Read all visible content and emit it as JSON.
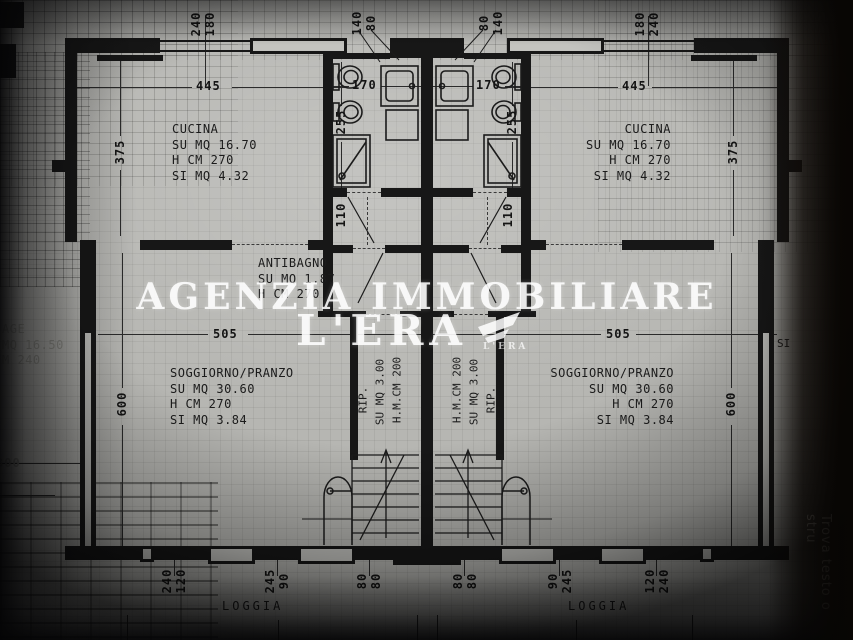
{
  "watermark": {
    "line1": "AGENZIA IMMOBILIARE",
    "line2": "L'ERA",
    "logo_caption": "L'ERA",
    "color": "#ffffff"
  },
  "side_overlay": {
    "vertical_text": "Trova testo o stru",
    "fragment_si": "SI"
  },
  "rooms": {
    "cucina_left": {
      "name": "CUCINA",
      "l2": "SU MQ 16.70",
      "l3": "H CM 270",
      "l4": "SI MQ 4.32"
    },
    "cucina_right": {
      "name": "CUCINA",
      "l2": "SU MQ 16.70",
      "l3": "H CM 270",
      "l4": "SI MQ 4.32"
    },
    "antibagno": {
      "name": "ANTIBAGNO",
      "l2": "SU MQ 1.87",
      "l3": "H CM 270"
    },
    "soggiorno_left": {
      "name": "SOGGIORNO/PRANZO",
      "l2": "SU MQ 30.60",
      "l3": "H CM 270",
      "l4": "SI MQ 3.84"
    },
    "soggiorno_right": {
      "name": "SOGGIORNO/PRANZO",
      "l2": "SU MQ 30.60",
      "l3": "H CM 270",
      "l4": "SI MQ 3.84"
    },
    "rip_left": {
      "l1": "RIP.",
      "l2": "SU MQ 3.00",
      "l3": "H.M.CM 200"
    },
    "rip_right": {
      "l1": "H.M.CM 200",
      "l2": "SU MQ 3.00",
      "l3": "RIP."
    },
    "garage_clipped": {
      "l1": "AGE",
      "l2": "MQ 16.50",
      "l3": "M 240"
    },
    "loggia_left": "LOGGIA",
    "loggia_right": "LOGGIA"
  },
  "dims": {
    "top_pair_left": [
      "240",
      "180"
    ],
    "top_pair_right": [
      "180",
      "240"
    ],
    "entry_pair_left": [
      "140",
      "80"
    ],
    "entry_pair_right": [
      "80",
      "140"
    ],
    "kitchen_w_left": "445",
    "kitchen_w_right": "445",
    "kitchen_h_left": "375",
    "kitchen_h_right": "375",
    "bath_w_left": "170",
    "bath_w_right": "170",
    "bath_h_left": "255",
    "bath_h_right": "255",
    "hall_left": "110",
    "hall_right": "110",
    "living_w_left": "505",
    "living_w_right": "505",
    "living_h_left": "600",
    "living_h_right": "600",
    "garage_w": "300",
    "loggia_left_pairs": [
      [
        "240",
        "120"
      ],
      [
        "245",
        "90"
      ],
      [
        "80",
        "80"
      ]
    ],
    "loggia_right_pairs": [
      [
        "80",
        "80"
      ],
      [
        "90",
        "245"
      ],
      [
        "120",
        "240"
      ]
    ]
  }
}
